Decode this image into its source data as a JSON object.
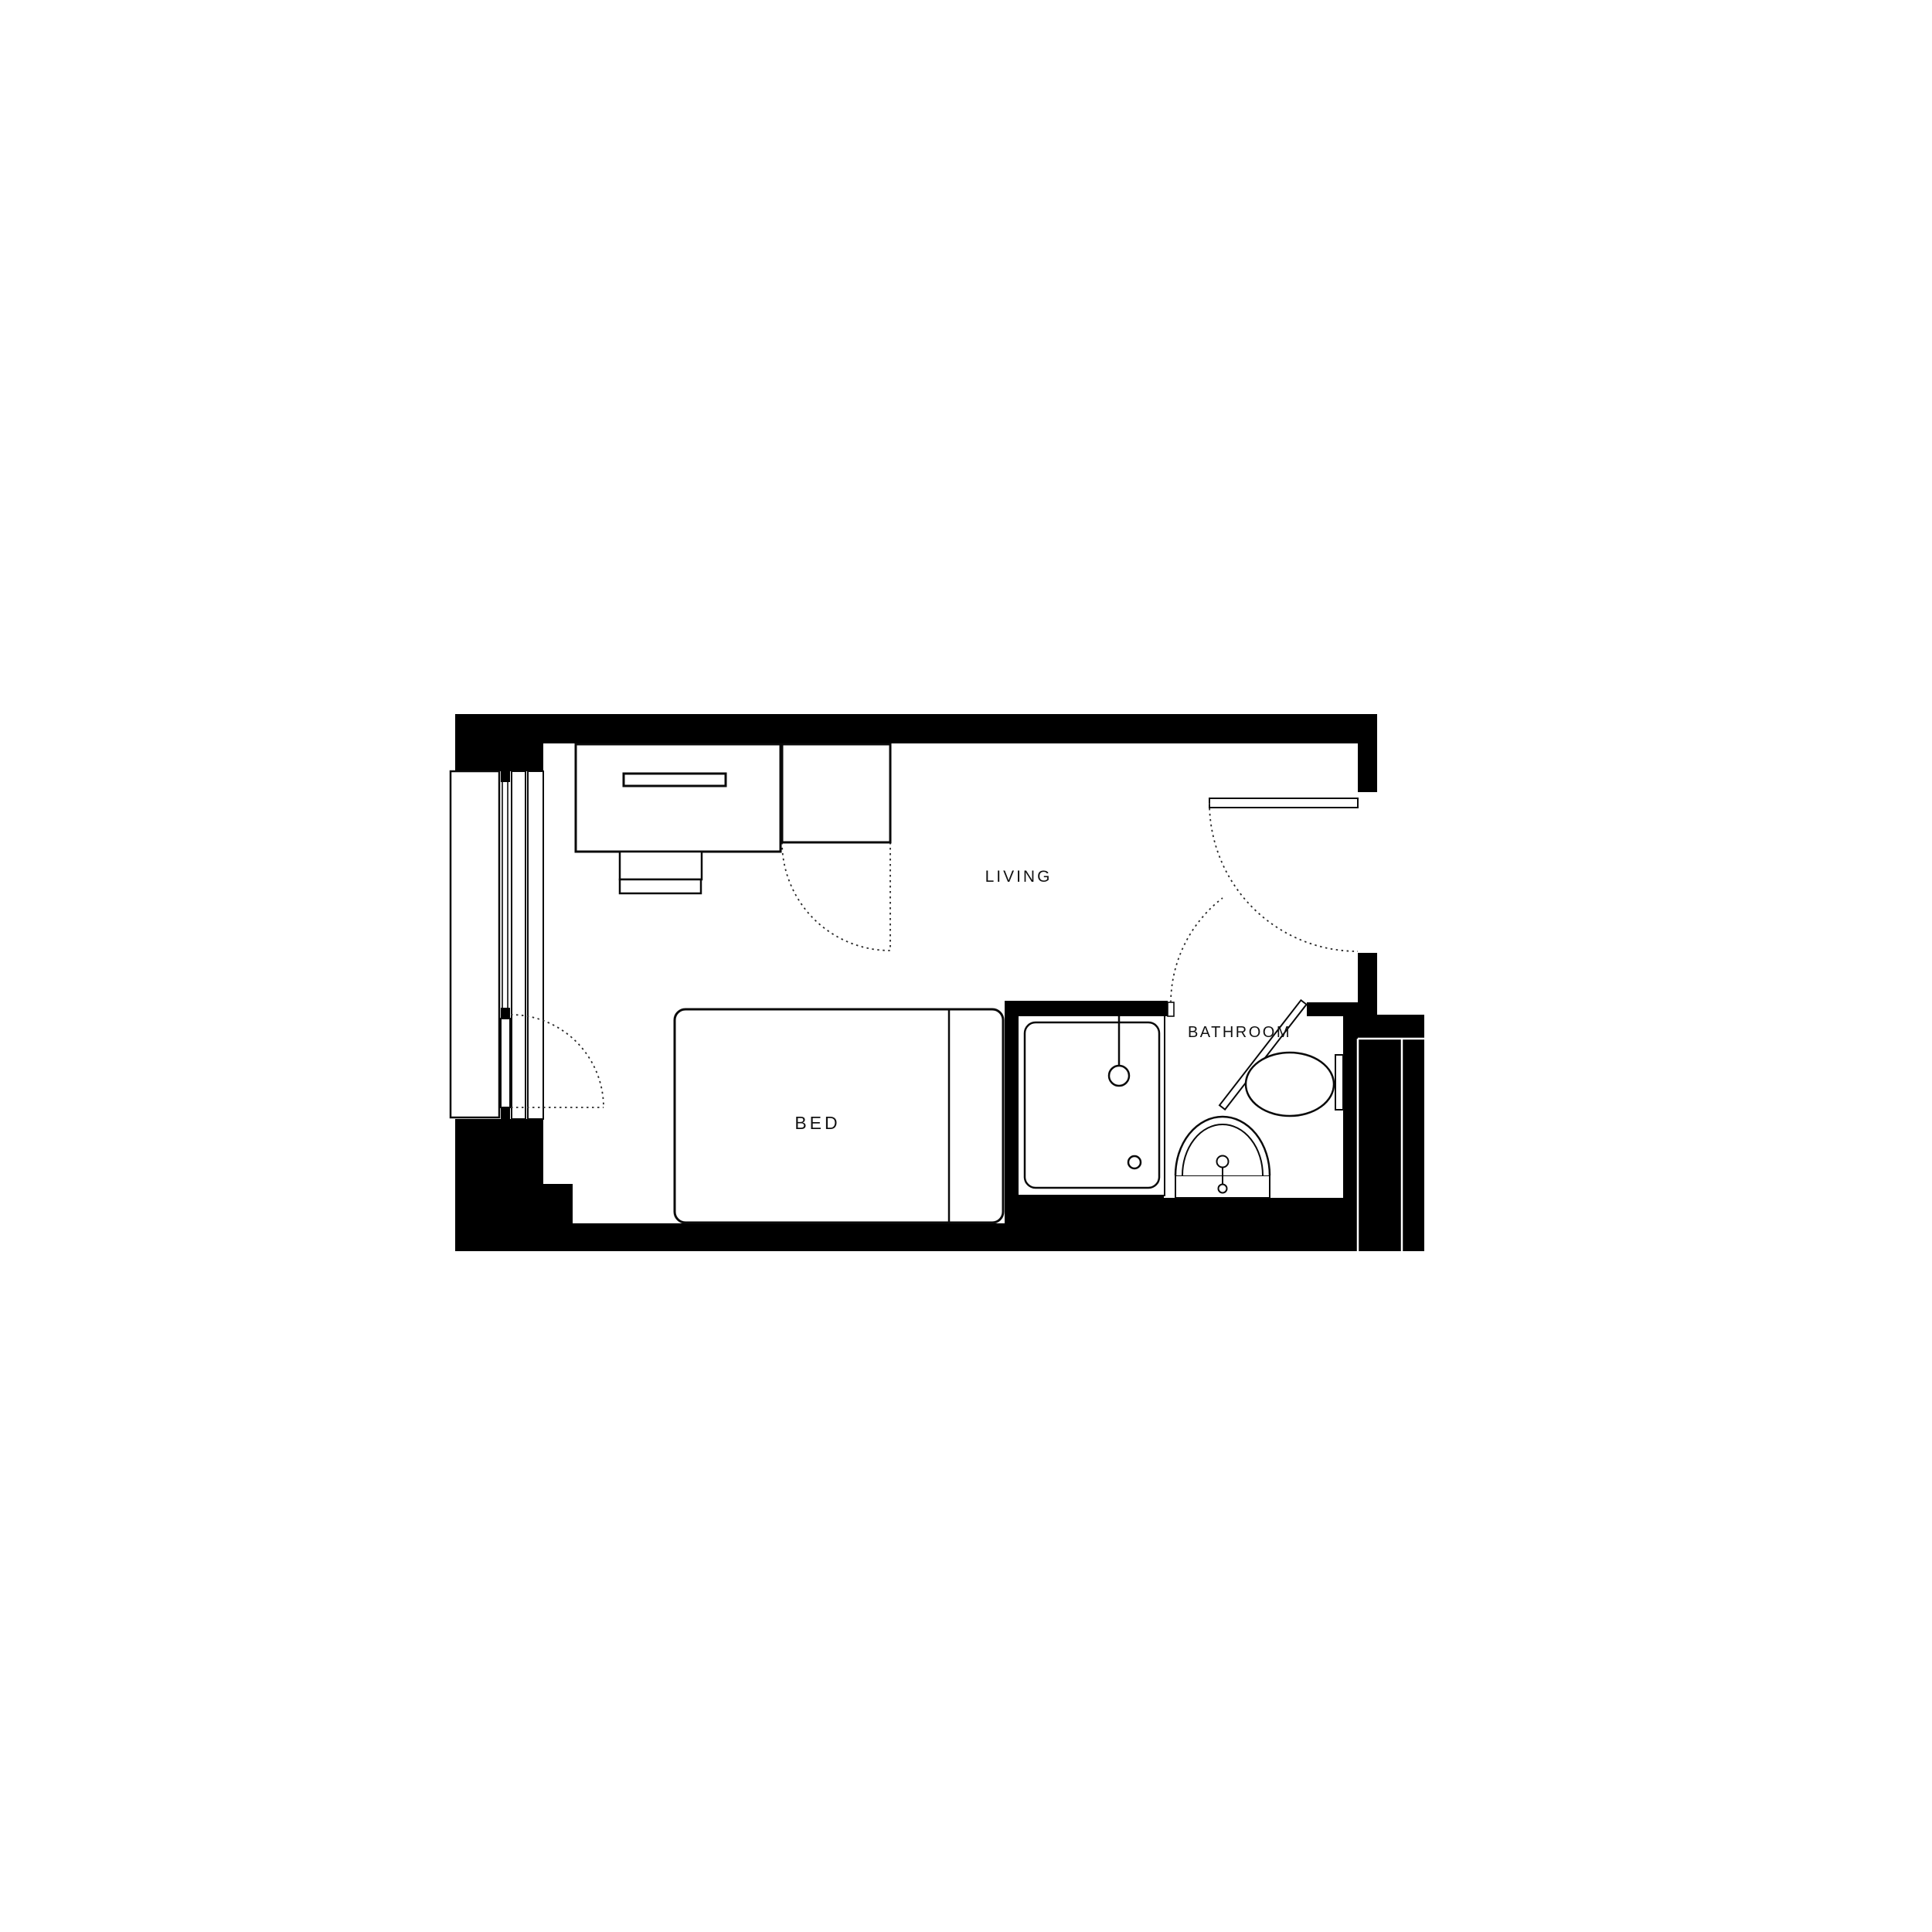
{
  "page": {
    "background": "#ffffff",
    "wall_color": "#000000",
    "line_color": "#0a0a0a",
    "dash_color": "#2a2a2a",
    "label_color": "#111111"
  },
  "plan": {
    "type": "studio-apartment-floor-plan",
    "labels": {
      "living": "LIVING",
      "bed": "BED",
      "bathroom": "BATHROOM"
    }
  }
}
